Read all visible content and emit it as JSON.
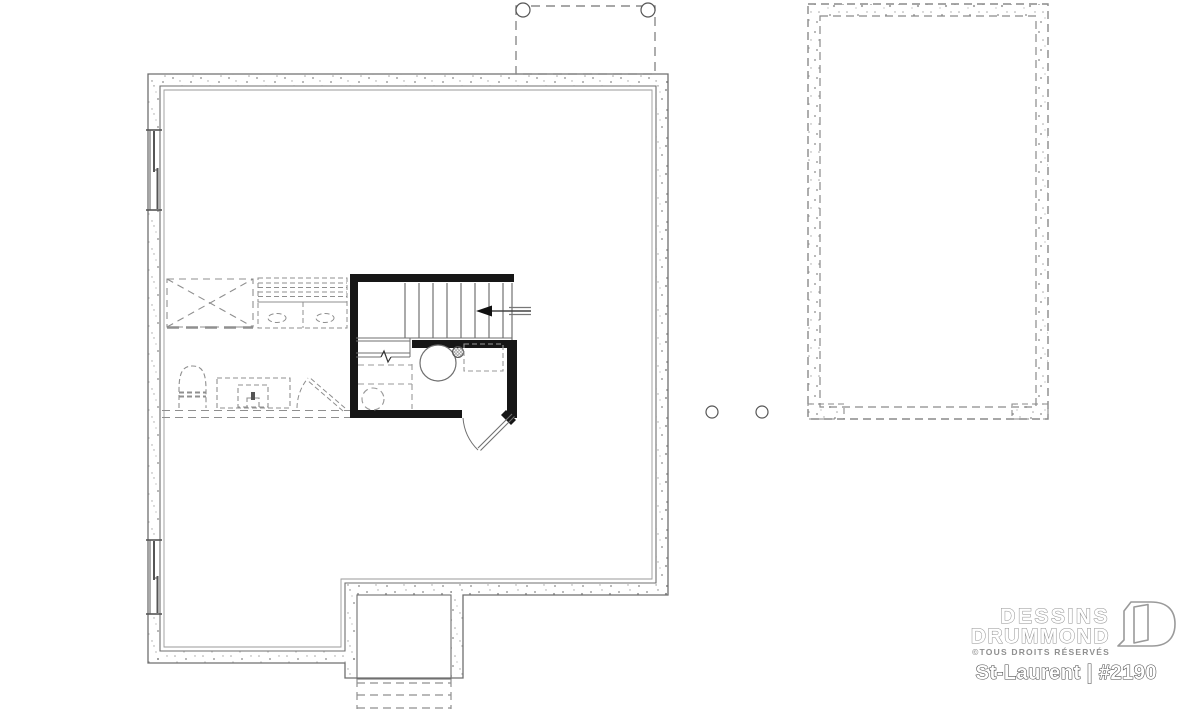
{
  "page": {
    "background": "#ffffff",
    "width": 1200,
    "height": 711
  },
  "branding": {
    "name_line1": "DESSINS",
    "name_line2": "DRUMMOND",
    "rights": "©TOUS DROITS RÉSERVÉS",
    "plan_title": "St-Laurent | #2190",
    "logo_icon": "open-door-d-icon"
  },
  "colors": {
    "background": "#ffffff",
    "wall_outline": "#6f6f6f",
    "stipple_dot": "#8c8c8c",
    "dashed_future": "#8f8f8f",
    "black_partition": "#161616",
    "logo_outline": "#8f8f8f",
    "title_outline": "#4a4a4a"
  },
  "plan": {
    "kind": "architectural-floor-plan",
    "level": "basement-foundation",
    "features": [
      "concrete-foundation-walls",
      "basement-window-upper-left",
      "basement-window-lower-left",
      "staircase-with-up-arrow",
      "future-bathroom-rough-in",
      "plumbing-rough-in-circle",
      "floor-drain",
      "future-vanity",
      "future-toilet",
      "water-heater",
      "furnace",
      "future-partition-wall",
      "future-storage-area",
      "future-counter",
      "cold-room-bump-out",
      "exterior-steps",
      "front-porch-footprint",
      "porch-sonotube-posts",
      "deck-post-footings",
      "detached-garage-foundation",
      "garage-footing-pads"
    ]
  }
}
